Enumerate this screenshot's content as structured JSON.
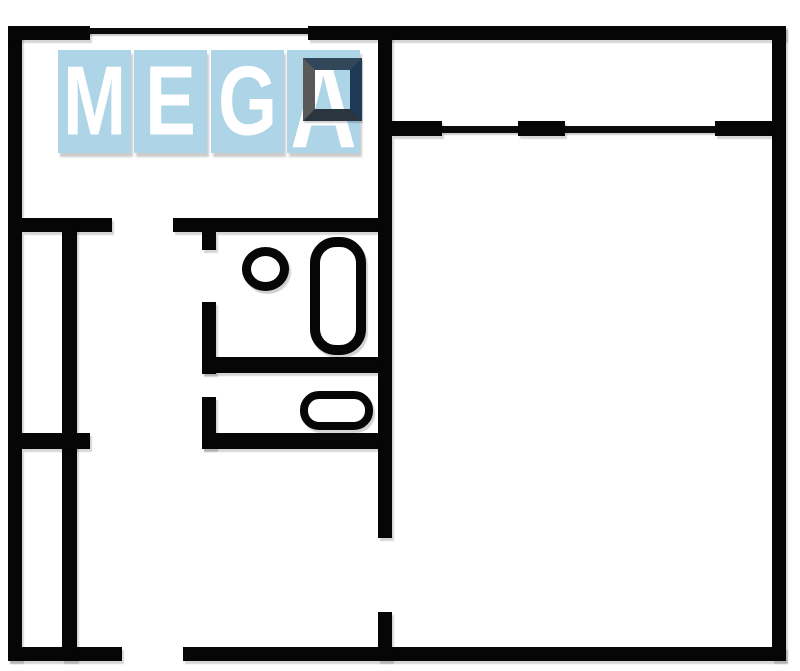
{
  "watermark": {
    "brand": "MEGA",
    "letters": [
      "M",
      "E",
      "G",
      "A"
    ],
    "colors": {
      "tile_blue": "#aed4e8",
      "letter_white": "#ffffff",
      "frame_navy": "#1e3a55",
      "frame_shadow_gray": "#595959"
    }
  },
  "floorplan": {
    "wall_color": "#060606",
    "background_color": "#ffffff",
    "fixtures": [
      {
        "name": "bathtub"
      },
      {
        "name": "sink"
      },
      {
        "name": "toilet"
      }
    ]
  }
}
